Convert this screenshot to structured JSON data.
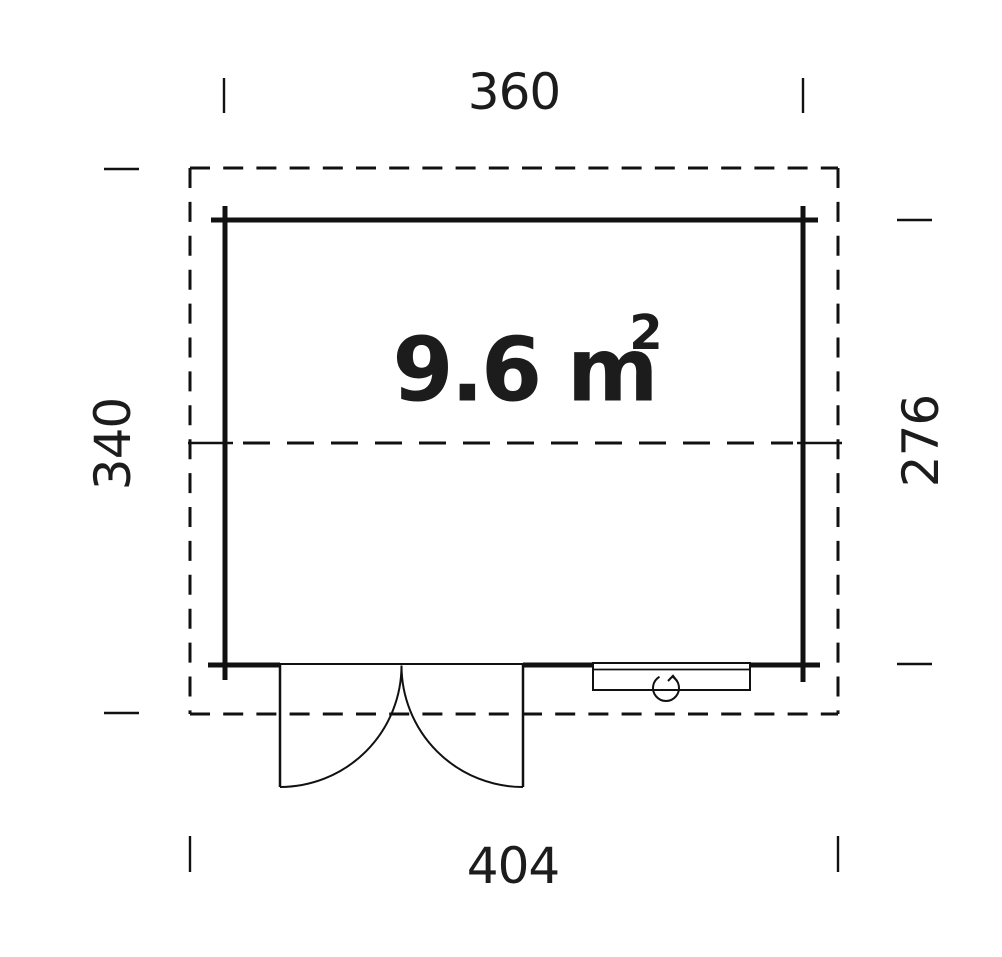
{
  "diagram": {
    "type": "floor-plan",
    "area_label": {
      "base": "9.6 m",
      "exponent": "2"
    },
    "dimensions": {
      "width_top": "360",
      "width_bottom": "404",
      "height_left": "340",
      "height_right": "276"
    },
    "icons": {
      "door": "double-door-swing-icon",
      "window": "tilt-window-pivot-icon"
    },
    "colors": {
      "line": "#111111",
      "text": "#1c1c1c",
      "background": "#ffffff"
    }
  }
}
